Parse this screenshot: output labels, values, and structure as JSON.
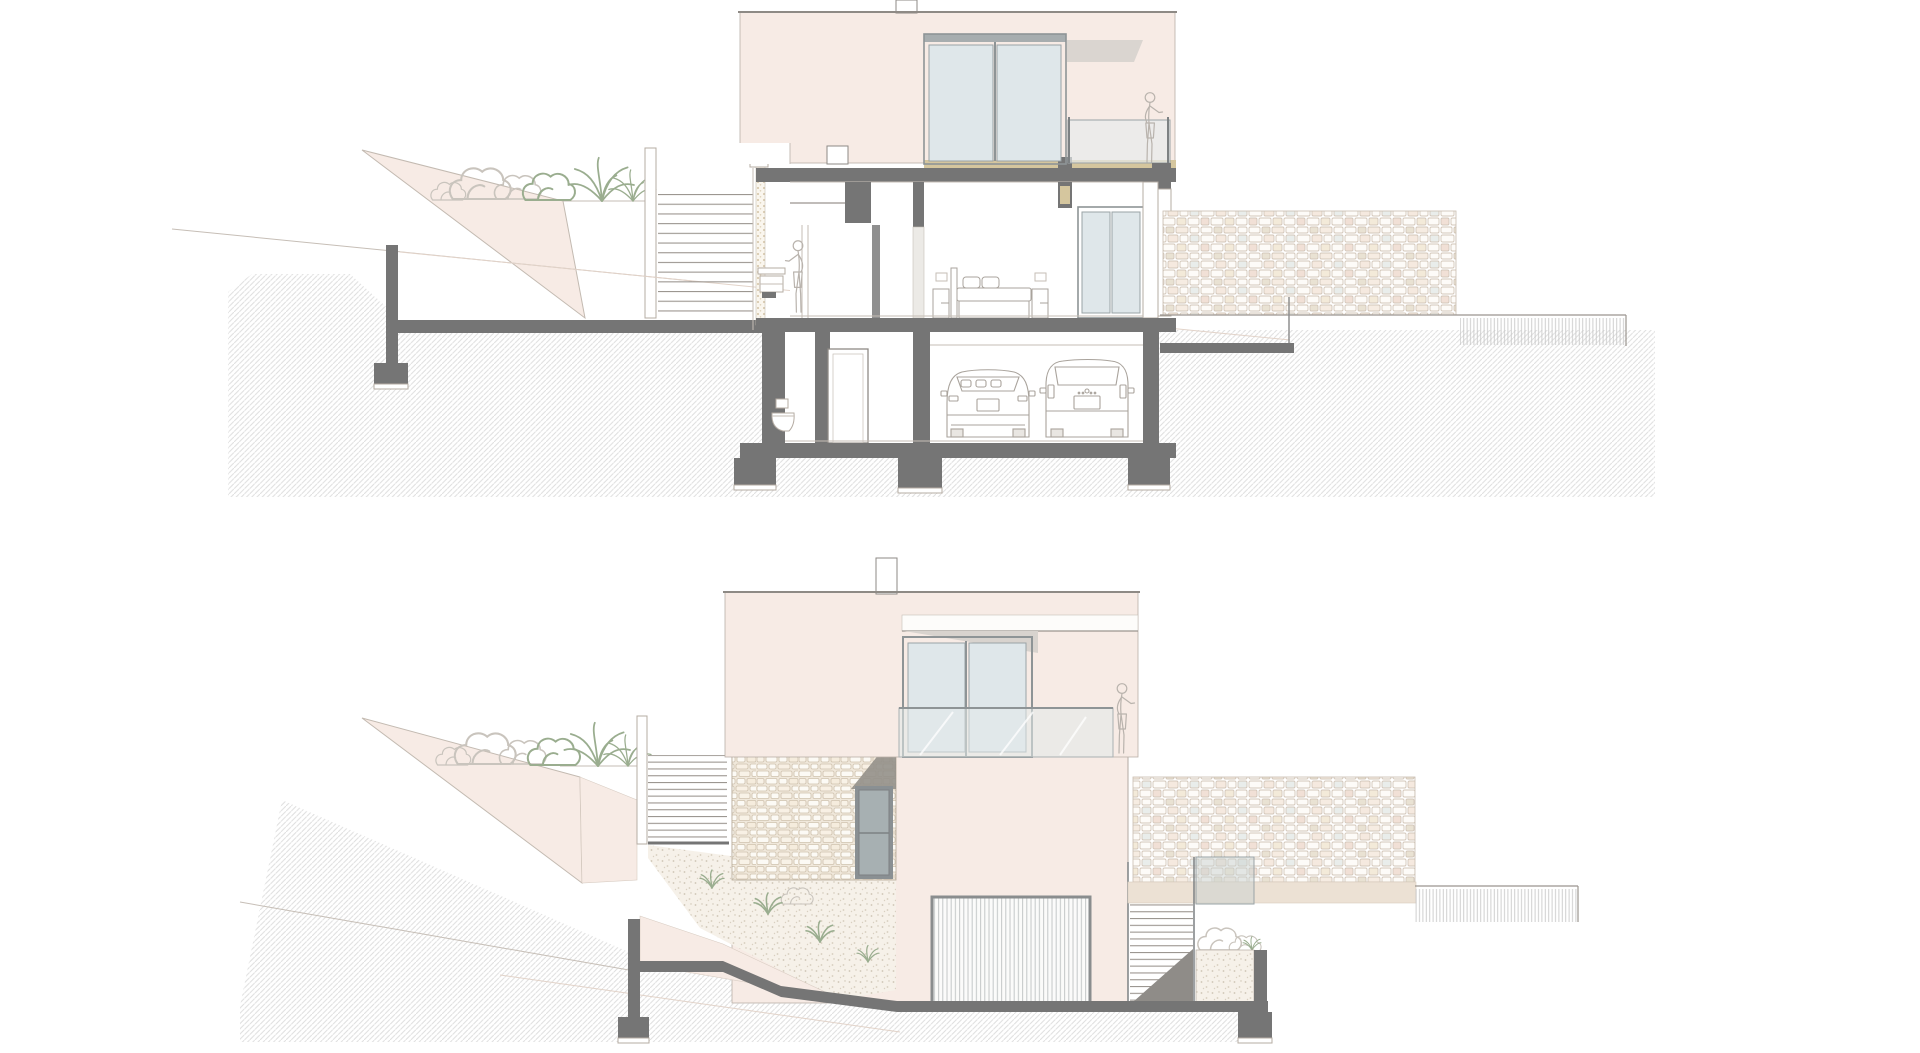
{
  "sheet": {
    "title": "",
    "drawings": [
      {
        "id": "section",
        "kind": "building cross-section",
        "depicts": [
          "hillside ground hatching",
          "planted terrace with shrubs and palm grasses",
          "garden retaining wedge",
          "staircase",
          "bathroom with woman at vanity",
          "bedroom with double bed and nightstands",
          "upper floor sliding glass door",
          "balcony with woman figure",
          "garage with hatchback car and minivan",
          "toilet",
          "concrete slabs and footings",
          "dry stone retaining wall",
          "gravel drain strip"
        ]
      },
      {
        "id": "elevation",
        "kind": "street elevation",
        "depicts": [
          "hillside ground hatching",
          "planted terrace with shrubs and palm grasses",
          "garden retaining wedge",
          "external stair",
          "stone-clad stair tower",
          "entrance door",
          "sliding glass door with glass balustrade",
          "woman figure on balcony",
          "roof chimney",
          "garage sectional door",
          "garden slope with grass tufts",
          "external stair to terrace",
          "planter with shrubs",
          "dry stone wall",
          "gravel drain strip",
          "concrete ground beam and footings"
        ]
      }
    ],
    "figures_count": 3,
    "vehicles_count": 2
  },
  "colors": {
    "paper": "#ffffff",
    "wall_pink": "#f7ebe5",
    "glass": "#dfe7ea",
    "glass_frame": "#8e9496",
    "door_glass": "#a7b0b2",
    "concrete": "#757575",
    "line": "#9b958f",
    "tan_sill": "#d5c69e",
    "beige_path": "#ece1d4",
    "stone_outline": "#cfc3b4",
    "hatch": "#dedede",
    "plant_green": "#9aad8f",
    "shadow": "#94908a"
  }
}
